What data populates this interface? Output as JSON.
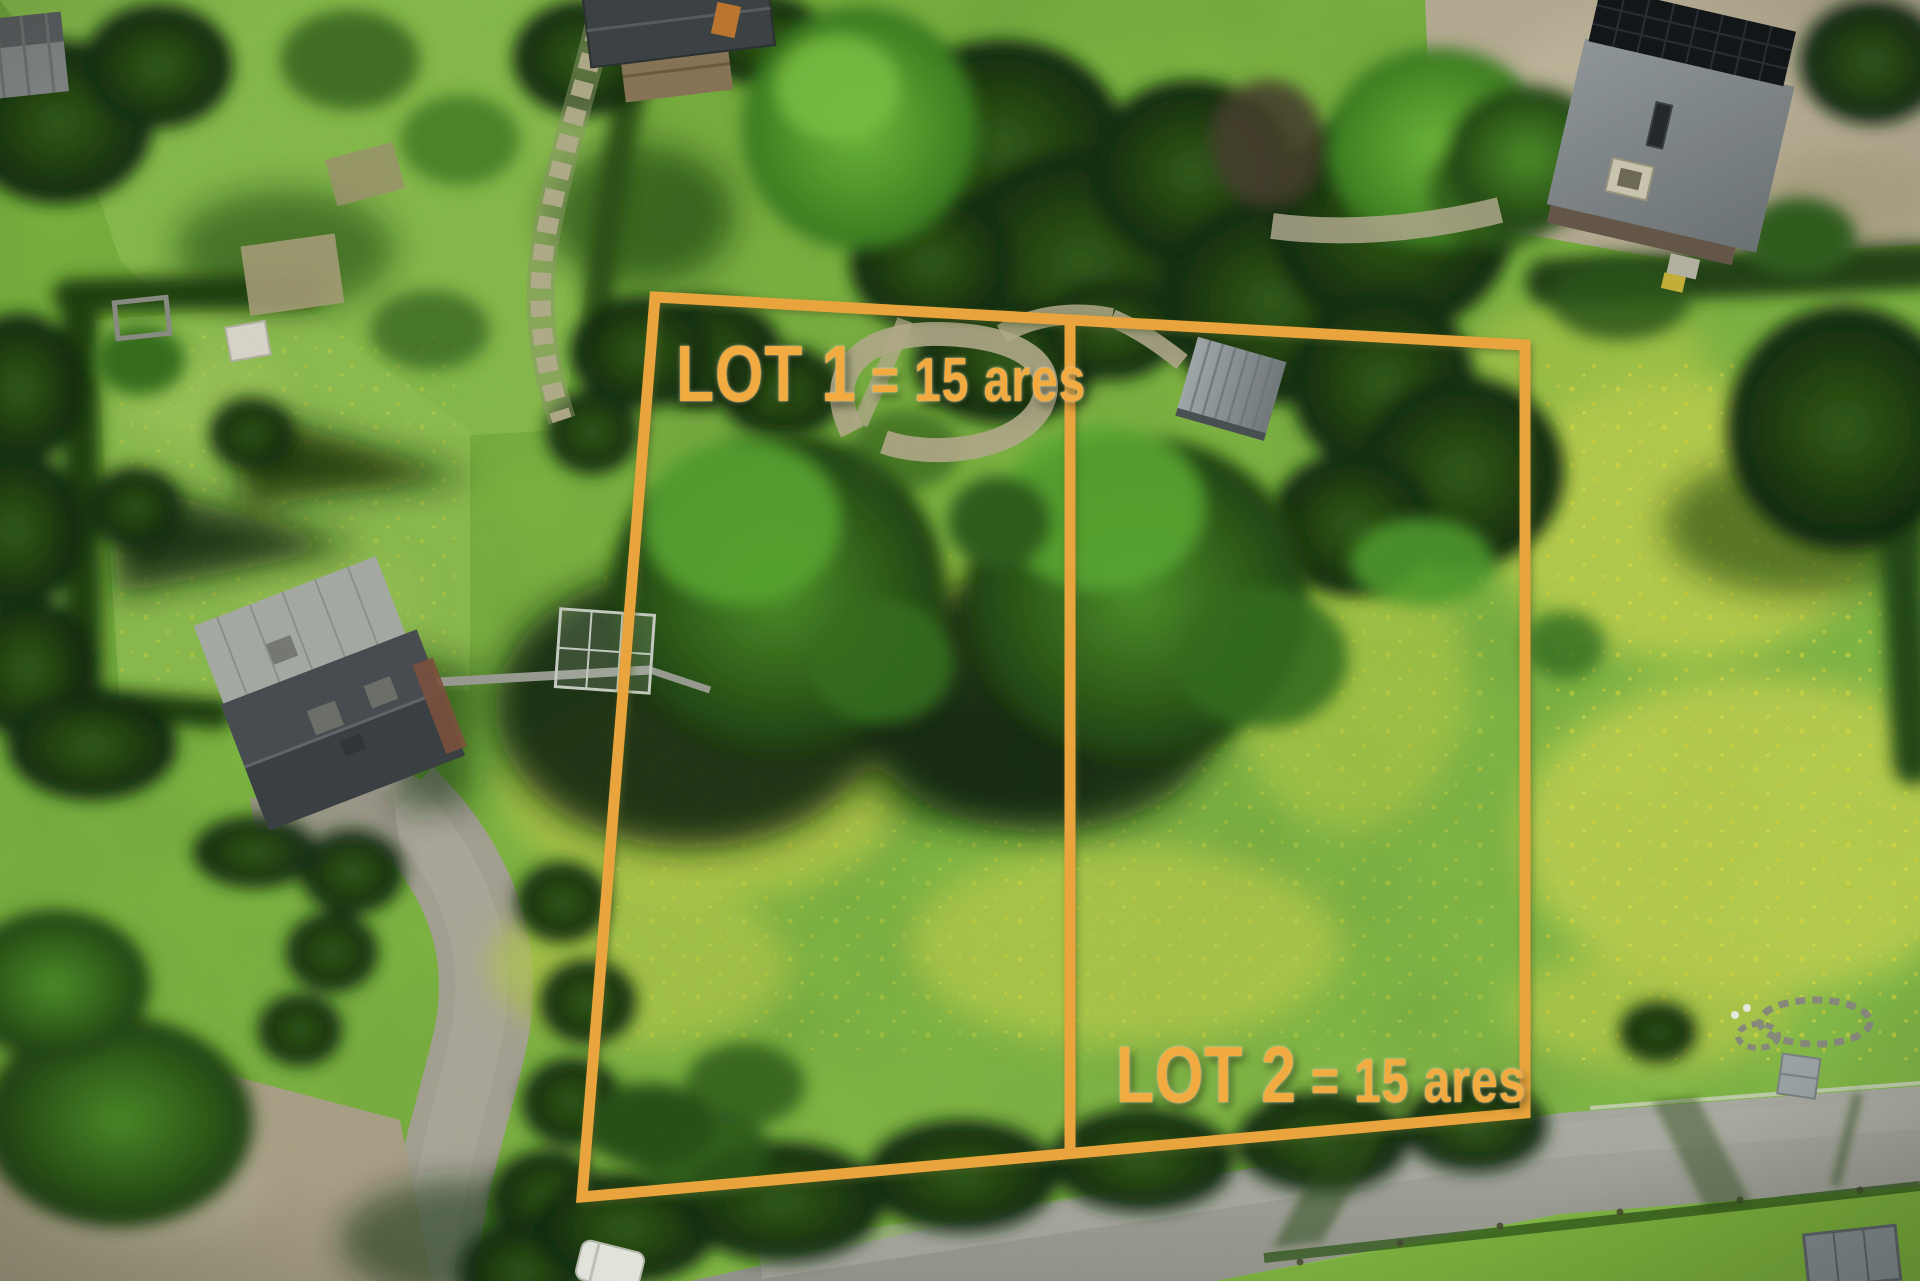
{
  "scene": {
    "type": "aerial-drone-photo",
    "description": "Aerial drone view of a green rural property split into two building plots outlined in orange, surrounded by gardens, hedges, houses with slate roofs, large trees, flower meadows and a road along the bottom right"
  },
  "overlay": {
    "color": "#E9A43E",
    "text_color": "#F2AB41",
    "lots": [
      {
        "id": "lot-1",
        "name": "LOT 1",
        "size_text": "= 15 ares"
      },
      {
        "id": "lot-2",
        "name": "LOT 2",
        "size_text": "= 15 ares"
      }
    ]
  }
}
